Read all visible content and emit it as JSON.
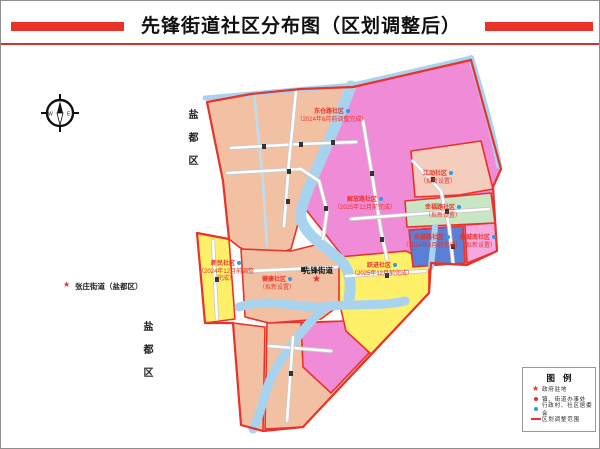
{
  "title": "先锋街道社区分布图（区划调整后）",
  "outside_labels": {
    "yandu_top": "盐都区",
    "yandu_bottom": "盐都区",
    "zhangzhuang": "张庄街道（盐都区）"
  },
  "street_office": {
    "name": "先锋街道",
    "marker": "★"
  },
  "communities": [
    {
      "name": "东仓路社区",
      "note": "（2024年6月前调整完成）",
      "color": "#f2c1a4"
    },
    {
      "name": "解放路社区",
      "note": "（2025年12月前完成）",
      "color": "#f08bd8"
    },
    {
      "name": "江动社区",
      "note": "（拟新设置）",
      "color": "#f4cdbe"
    },
    {
      "name": "幸福路社区",
      "note": "（拟新设置）",
      "color": "#c8e6c3"
    },
    {
      "name": "东城路社区",
      "note": "（2024年6月前完成）",
      "color": "#5b7ed6"
    },
    {
      "name": "新城南社区",
      "note": "（拟新设置）",
      "color": "#f6a9de"
    },
    {
      "name": "健康社区",
      "note": "（拟新设置）",
      "color": "#f2c1a4"
    },
    {
      "name": "跃进社区",
      "note": "（2025年12月前完成）",
      "color": "#fff06a"
    },
    {
      "name": "新民社区",
      "note": "（2024年12月前调整完成）",
      "color": "#fff06a"
    }
  ],
  "legend": {
    "title": "图例",
    "items": [
      {
        "symbol": "red-star",
        "label": "政府驻地"
      },
      {
        "symbol": "red-dot",
        "label": "镇、街道办事处"
      },
      {
        "symbol": "blue-dot",
        "label": "行政村、社区居委会"
      },
      {
        "symbol": "red-line",
        "label": "区划调整范围"
      }
    ]
  },
  "compass": {
    "west": "W",
    "east": "E"
  },
  "colors": {
    "boundary": "#e8322a",
    "river": "#a8d3ee",
    "salmon": "#f2c1a4",
    "magenta": "#f08bd8",
    "title_red": "#e8322a",
    "committee_dot_blue": "#2e9be6"
  }
}
